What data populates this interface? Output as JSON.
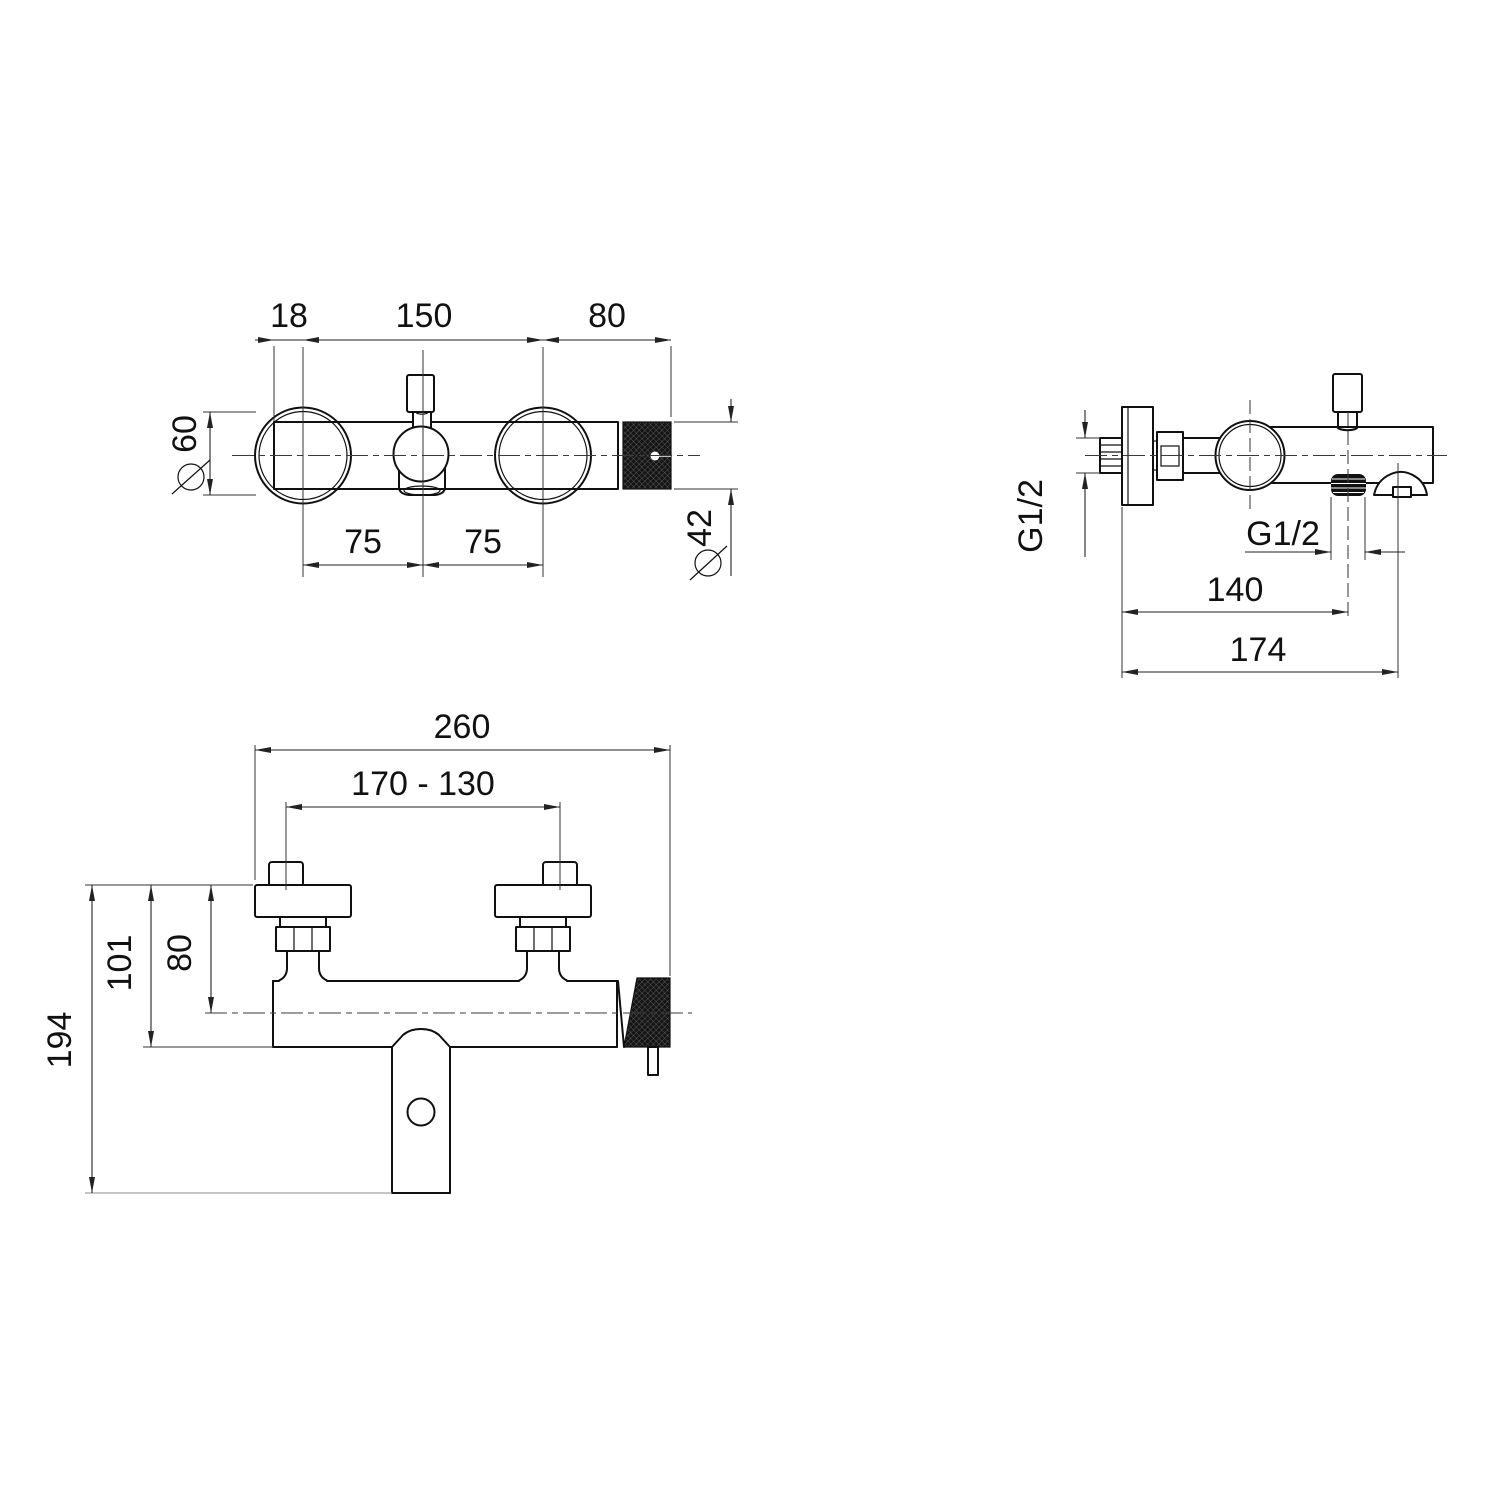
{
  "drawing_title": "bath-shower-mixer-technical-drawing",
  "views": {
    "top": {
      "label_18": "18",
      "label_150": "150",
      "label_80": "80",
      "label_75_1": "75",
      "label_75_2": "75",
      "label_dia60": "60",
      "label_dia42": "42"
    },
    "side": {
      "label_g12_wall": "G1/2",
      "label_g12_outlet": "G1/2",
      "label_140": "140",
      "label_174": "174"
    },
    "front": {
      "label_260": "260",
      "label_170_130": "170 - 130",
      "label_101": "101",
      "label_80": "80",
      "label_194": "194"
    }
  }
}
